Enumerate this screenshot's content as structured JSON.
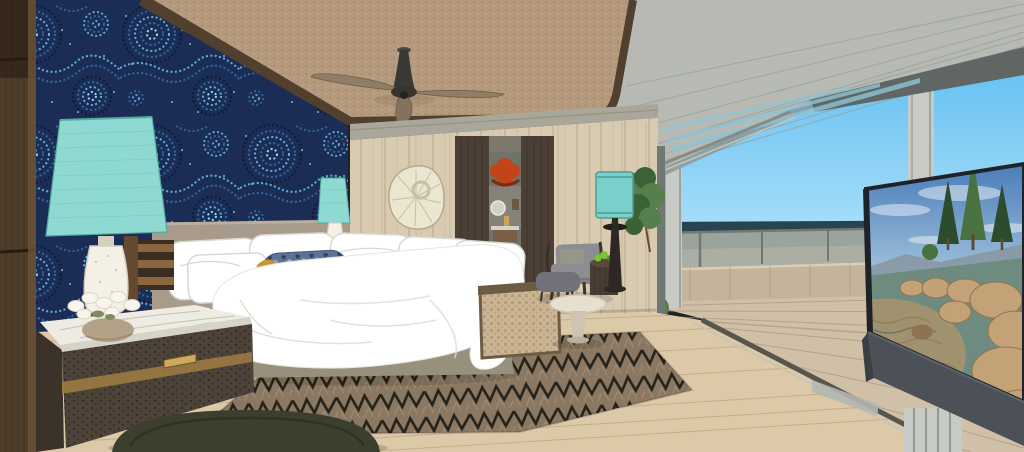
{
  "scene": {
    "type": "3d-architectural-rendering",
    "description": "Coastal modern bedroom rendering: blue aboriginal dot-art accent wall with aqua table lamp, white bed with patterned bolster, woven ceiling with fan, oak wall with doorway to a bathroom with red pendant art, lounge chair and floor lamp, chevron rug, olive pouf, open glass wall onto an ocean-view deck with glass railing under a grey timber roof overhang, and an angled TV showing a lake scene with boulders and pine trees",
    "objects": [
      "dark wood column",
      "dot-art wallpaper",
      "woven ceiling",
      "ceiling fan",
      "aqua table lamp",
      "orchid flowers",
      "marble-top credenza",
      "slat bench",
      "headboard",
      "pillows",
      "bolster pillow",
      "white duvet",
      "bedside chest",
      "small aqua lamp",
      "shell wall art",
      "oak wall panels",
      "wardrobe panels",
      "bathroom doorway",
      "red pendant art",
      "round mirror",
      "vanity",
      "pink bench",
      "cane bench",
      "chevron rug",
      "olive pouf",
      "wood floor",
      "armchair",
      "ottoman",
      "drum side table",
      "succulent",
      "round coffee table",
      "teal floor lamp",
      "indoor plant",
      "glass door mullion",
      "deck post",
      "roof post",
      "roof overhang",
      "sky",
      "ocean horizon",
      "glass railing",
      "timber parapet",
      "deck boards",
      "outdoor shrub",
      "tv screen",
      "tv media slab"
    ]
  },
  "palette": {
    "sky_top": "#4ab5f0",
    "sky_horizon": "#c8ecfb",
    "sea": "#2a4350",
    "glass": "#9aa49d",
    "glass_frame": "#6f7872",
    "glass_reflect": "#bcb8a8",
    "parapet": "#c4b49c",
    "parapet_line": "#a7927a",
    "parapet_cap": "#dccdb4",
    "deck": "#d0c0a8",
    "deck_line": "#a6937c",
    "deck_shadow": "#8e7e68",
    "roof": "#b6bab3",
    "roof_line": "#9da19a",
    "roof_fascia": "#5f6663",
    "roof_soffit": "#8b9090",
    "roof_slot": "#8ec4d6",
    "post": "#c8cbc5",
    "post_edge": "#9fa39d",
    "header_track": "#878b85",
    "ceiling": "#b59a7d",
    "ceiling_dot": "#a1866a",
    "ceiling_dot2": "#c3aa8b",
    "trim": "#52402e",
    "wp_bg": "#1b2d55",
    "wp_navy": "#0e1b38",
    "wp_mid": "#3566a2",
    "wp_light": "#5fb0d8",
    "wp_pale": "#9ad8ec",
    "wp_dot": "#d6eef8",
    "column": "#4e3c2b",
    "column_dark": "#261c11",
    "column_line": "#3a2c1d",
    "column_face": "#6b5238",
    "oak": "#d9cbb2",
    "oak_line": "#c2b194",
    "soffit": "#a8a79a",
    "soffit_line": "#908f7d",
    "door_panel": "#4c4036",
    "door_line": "#383026",
    "hall_bg": "#70736a",
    "hall_lintel": "#7d796d",
    "hall_wall": "#8f8a7d",
    "hall_floor": "#4e483f",
    "art_red": "#c24418",
    "art_red_dark": "#7e2a0e",
    "mirror_glass": "#ccd2ca",
    "mirror_ring": "#ece8da",
    "vanity_counter": "#d8d2c2",
    "vanity_wood": "#7a5f46",
    "gold": "#c9a55c",
    "bench_pink": "#dc9b93",
    "bench_pink_dot": "#b5655f",
    "bench_pink_base": "#8a5a50",
    "shell": "#eae6d0",
    "shell_line": "#b3ab8e",
    "shell_shadow": "#c6bfa5",
    "headboard": "#a89b8b",
    "headboard_lip": "#bcae9d",
    "bed_base": "#97907d",
    "white": "#ffffff",
    "pillow_line": "#d8d8d2",
    "duvet_line": "#dcdcd6",
    "bolster_blue": "#5d7296",
    "bolster_dark": "#31405e",
    "bolster_mid": "#93a8c6",
    "bolster_navy": "#1e2d4f",
    "bolster_gold": "#c9952e",
    "lamp_teal": "#8edad2",
    "lamp_teal_line": "#6fc4bc",
    "lamp_teal_dark": "#55aaa2",
    "lamp_white": "#f4f0e5",
    "lamp_white_line": "#d5cfbf",
    "marble": "#edebe2",
    "marble_edge": "#d6d3c8",
    "marble_vein": "#b9b6aa",
    "drawer": "#4d4339",
    "drawer_dark": "#352e26",
    "brass": "#9c7a42",
    "brass_light": "#cfa95e",
    "slat": "#8a6540",
    "slat_dark": "#644830",
    "slat_gap": "#3a2e20",
    "floor": "#dcc9a7",
    "floor_line": "#b99c76",
    "track_dark": "#57564c",
    "track_light": "#c9c4b4",
    "rug_base": "#8a7862",
    "rug_dark": "#242219",
    "rug_tan": "#ab977b",
    "cane": "#cab494",
    "cane_dark": "#a58c66",
    "cane_frame": "#6d5b44",
    "pouf": "#3c3f2e",
    "pouf_dark": "#2b2e21",
    "chair_frame": "#3a322a",
    "cushion": "#8d8d91",
    "cushion_dark": "#71717a",
    "cushion_pillow": "#97968b",
    "sidetable": "#493c32",
    "sidetable_top": "#59493d",
    "apple": "#76c832",
    "coffee_table": "#e7dfd0",
    "coffee_table_dark": "#cdc4b1",
    "flamp_shade": "#79cfc9",
    "flamp_shade_dark": "#4f9e98",
    "flamp_stand": "#2d2823",
    "plant": "#567f4e",
    "plant_dark": "#3c6137",
    "trunk": "#6b4a2e",
    "stone": "#b3a287",
    "petal": "#f8f5ef",
    "petal_line": "#ddd6c8",
    "leaf": "#7f8d5e",
    "cab_side": "#3b332a",
    "tv_frame": "#1f2328",
    "tv_stand": "#4b5157",
    "tv_stand_dark": "#3a3f44",
    "tv_sky_top": "#3f74b4",
    "tv_sky_bot": "#a6c6de",
    "tv_cloud": "#e6edf4",
    "tv_mtn": "#8795a0",
    "tv_tree": "#2c4c2e",
    "tv_tree2": "#4a7140",
    "tv_trunk": "#5d4a32",
    "tv_rock": "#c4a278",
    "tv_rock_dark": "#8f7350",
    "tv_water": "#6d8b7f",
    "tv_sand": "#b2946a",
    "tv_ripple": "#8a7a56",
    "tv_ripple_dark": "#49675e"
  }
}
